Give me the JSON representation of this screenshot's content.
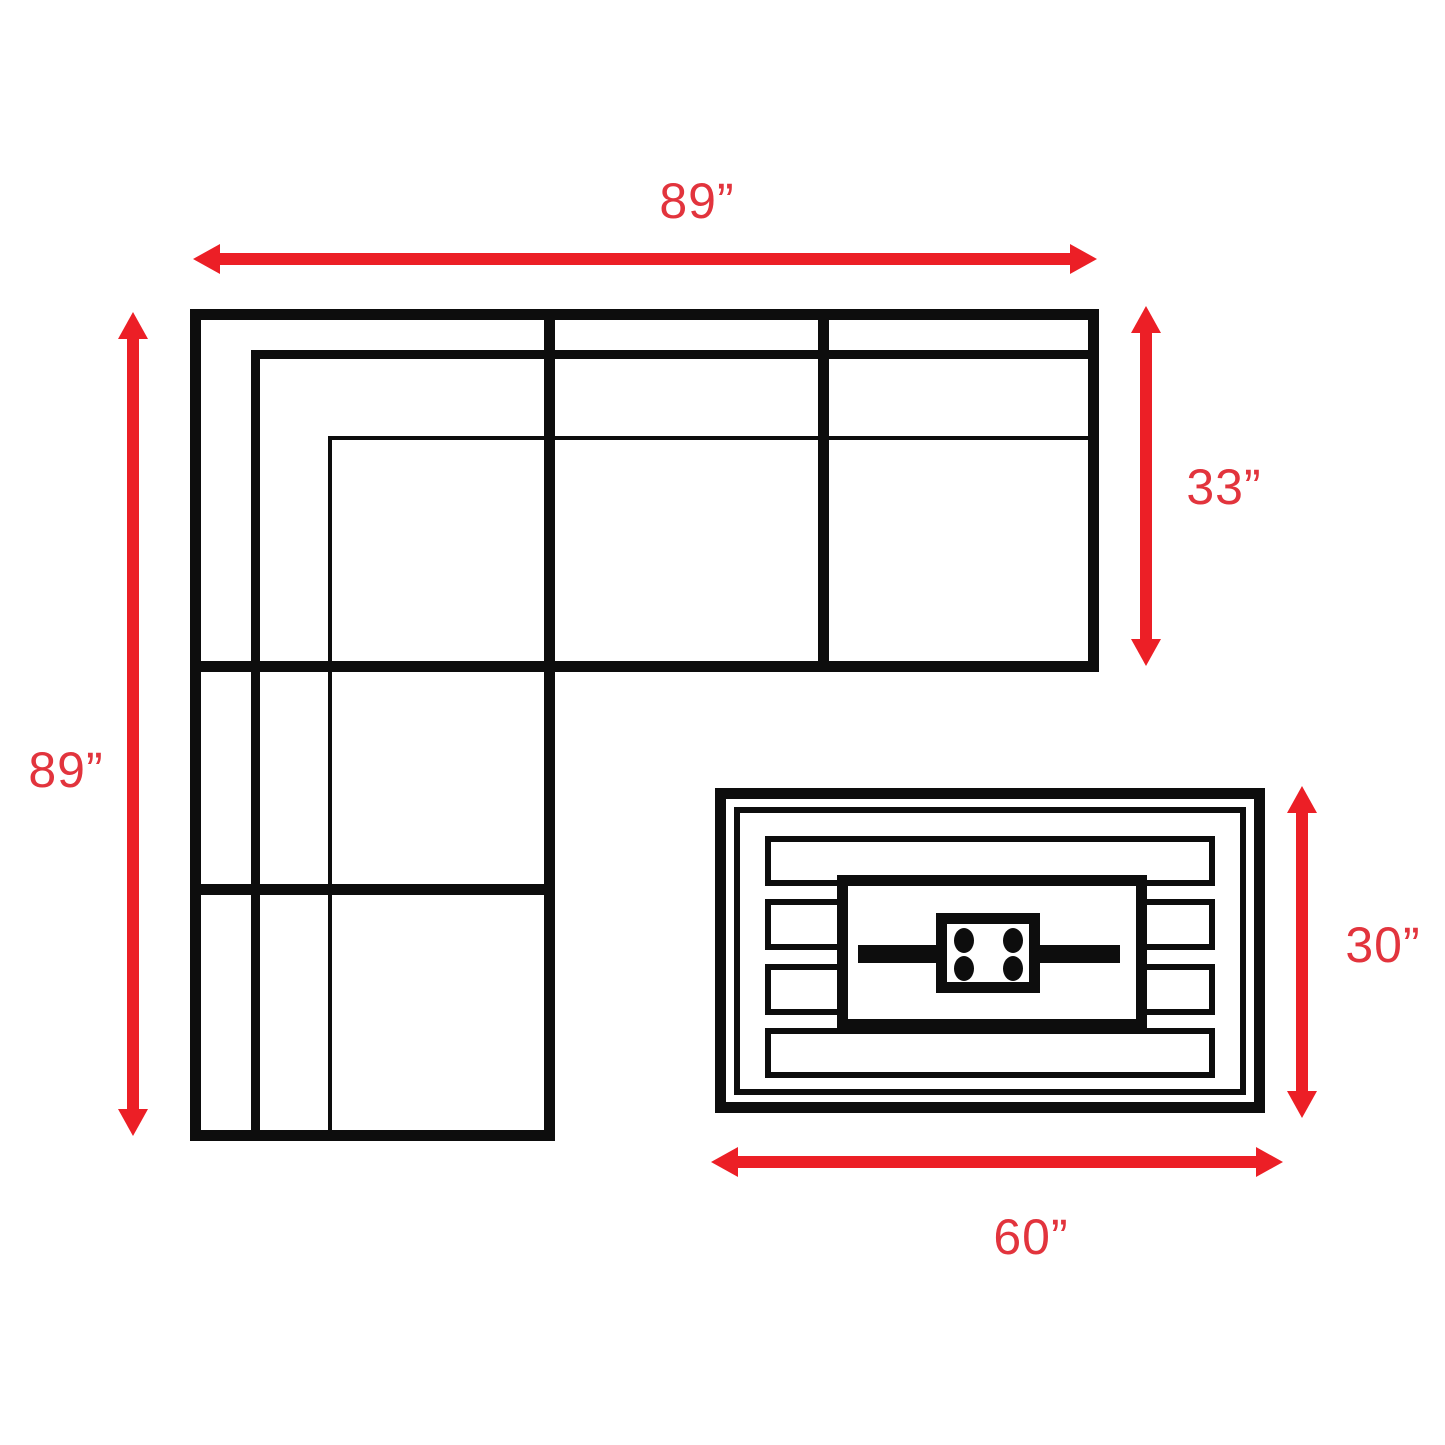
{
  "diagram": {
    "labels": {
      "sofa_width": "89”",
      "sofa_depth": "89”",
      "section_depth": "33”",
      "table_depth": "30”",
      "table_width": "60”"
    },
    "colors": {
      "arrow": "#EC1F26",
      "label": "#E2343D",
      "line": "#0D0D0D",
      "background": "#FFFFFF"
    }
  }
}
